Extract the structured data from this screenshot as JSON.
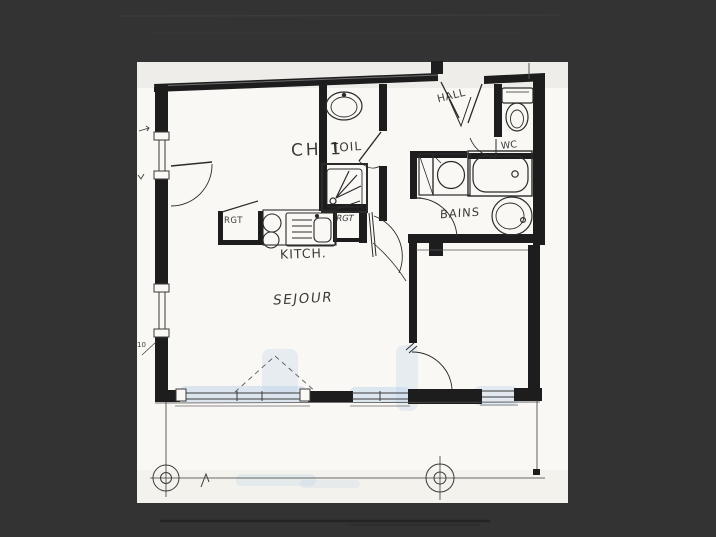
{
  "meta": {
    "type": "scanned architectural floor plan",
    "background_color": "#333333",
    "paper_color": "#f9f8f4",
    "ink_color": "#1d1d1d",
    "highlight_color": "#b8cfe8"
  },
  "labels": {
    "ch1": "CH 1",
    "toil": "TOIL",
    "hall": "HALL",
    "wc": "WC",
    "bains": "BAINS",
    "rgt_left": "RGT",
    "rgt_right": "RGT",
    "kitchen": "KITCH.",
    "sejour": "SEJOUR",
    "dim_note": "10"
  }
}
